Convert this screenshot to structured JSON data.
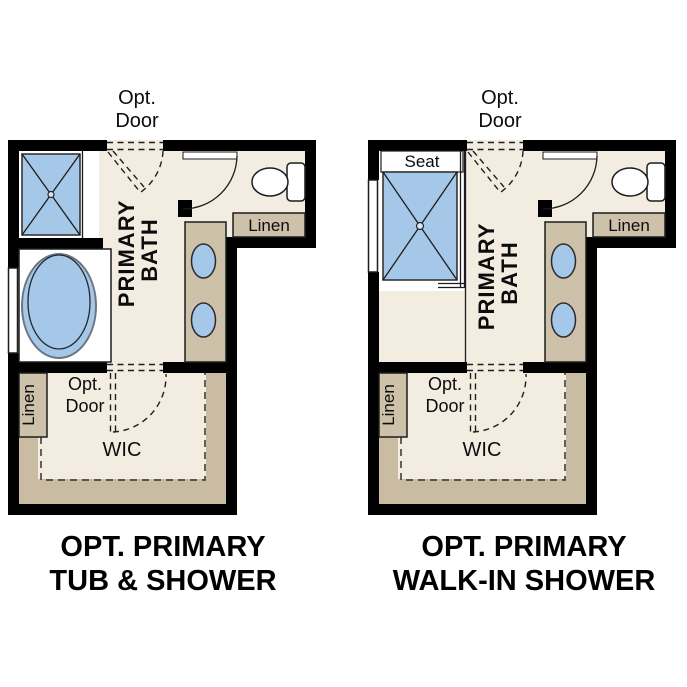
{
  "colors": {
    "background": "#ffffff",
    "wall": "#000000",
    "floor": "#f3ede1",
    "carpet": "#c9bca2",
    "cabinet": "#cdc1aa",
    "fixture_blue": "#a6c8e8",
    "outline": "#1c1c1c",
    "text": "#000000"
  },
  "left_plan": {
    "top_door_label": {
      "line1": "Opt.",
      "line2": "Door"
    },
    "room_label": {
      "line1": "PRIMARY",
      "line2": "BATH"
    },
    "toilet_linen_label": "Linen",
    "wic_linen_label": "Linen",
    "wic_door_label": {
      "line1": "Opt.",
      "line2": "Door"
    },
    "wic_label": "WIC",
    "title": {
      "line1": "OPT. PRIMARY",
      "line2": "TUB & SHOWER"
    }
  },
  "right_plan": {
    "top_door_label": {
      "line1": "Opt.",
      "line2": "Door"
    },
    "seat_label": "Seat",
    "room_label": {
      "line1": "PRIMARY",
      "line2": "BATH"
    },
    "toilet_linen_label": "Linen",
    "wic_linen_label": "Linen",
    "wic_door_label": {
      "line1": "Opt.",
      "line2": "Door"
    },
    "wic_label": "WIC",
    "title": {
      "line1": "OPT. PRIMARY",
      "line2": "WALK-IN SHOWER"
    }
  }
}
